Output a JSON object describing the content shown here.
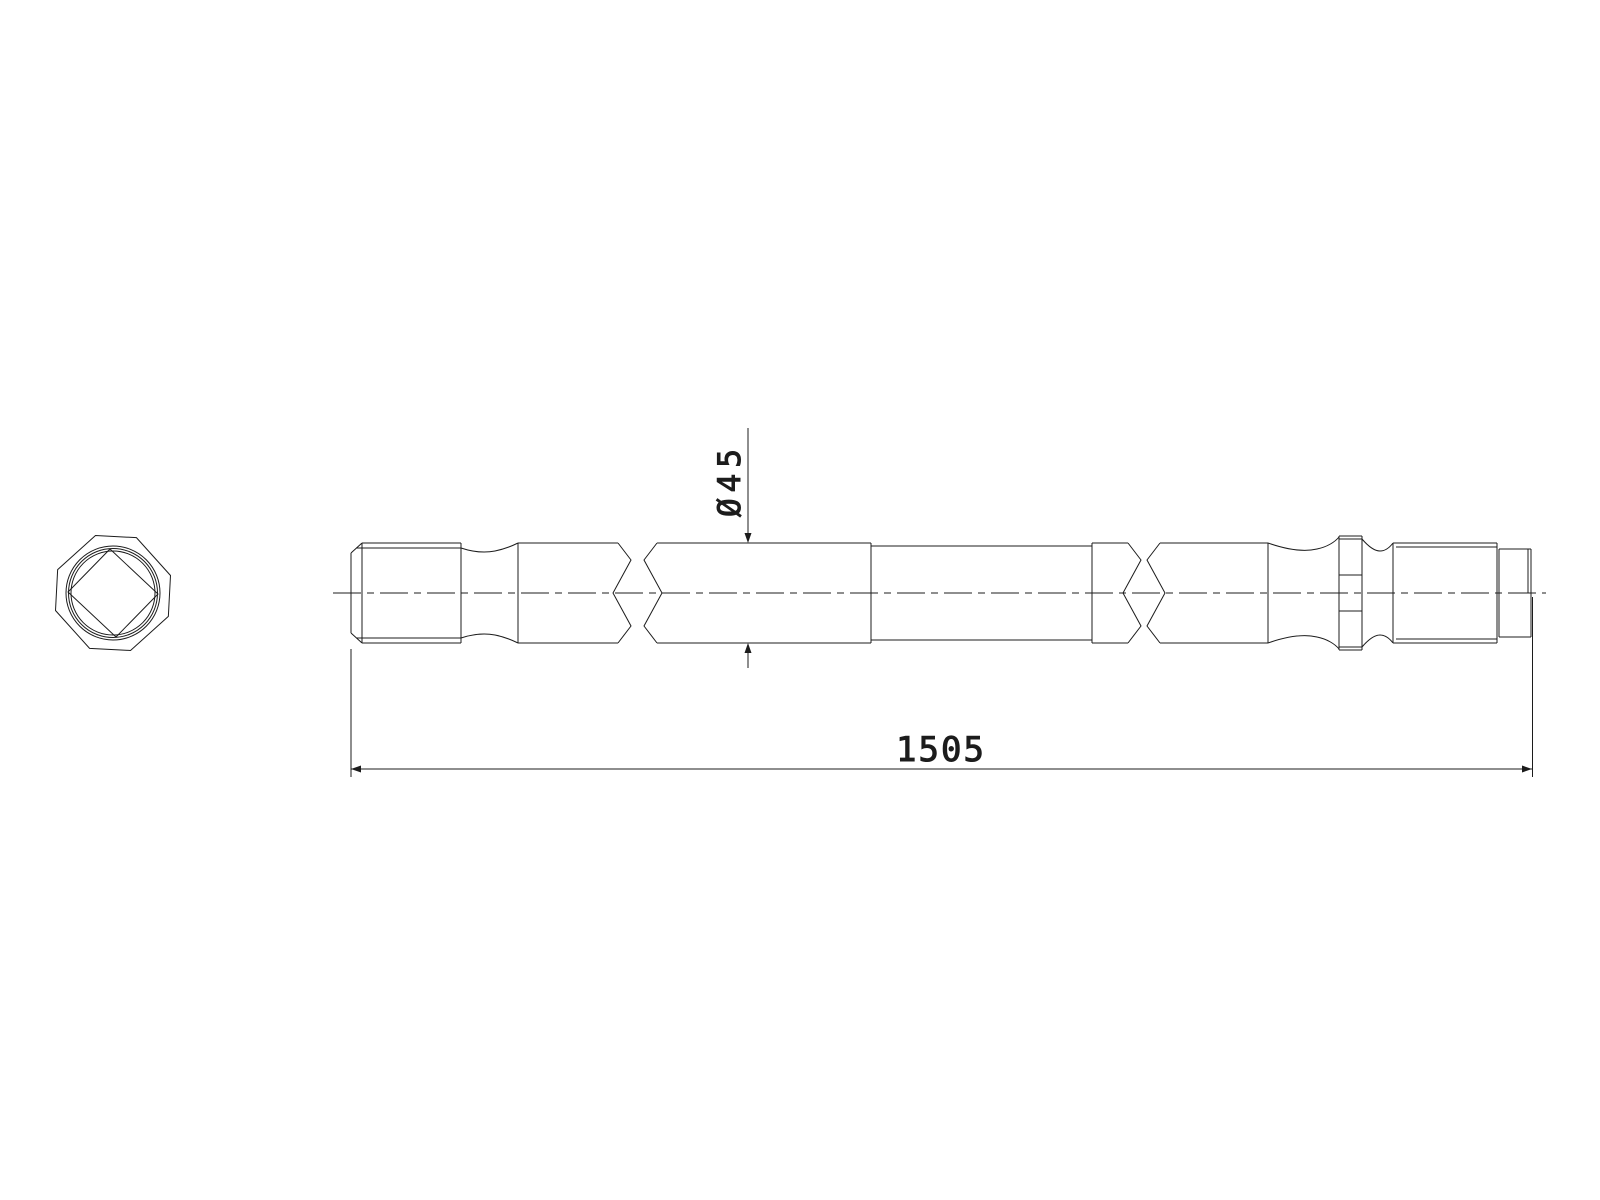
{
  "colors": {
    "background": "#ffffff",
    "line": "#1c1c1c"
  },
  "dimensions": {
    "diameter": {
      "label": "Ø45",
      "value": 45
    },
    "overall_length": {
      "label": "1505",
      "value": 1505
    }
  }
}
